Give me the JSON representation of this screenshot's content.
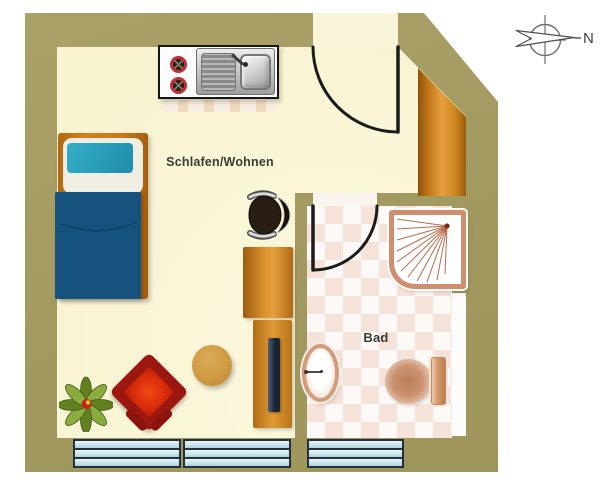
{
  "canvas": {
    "width": 600,
    "height": 492
  },
  "labels": {
    "room_main": "Schlafen/Wohnen",
    "room_bath": "Bad",
    "compass_north": "N"
  },
  "rooms": [
    {
      "id": "schlafen-wohnen",
      "label": "Schlafen/Wohnen"
    },
    {
      "id": "bad",
      "label": "Bad"
    }
  ],
  "colors": {
    "wall_olive": "#a49b61",
    "floor_main_cream": "#f8f4d2",
    "floor_bath_light": "#fdf9f6",
    "floor_bath_dark": "#f5e3da",
    "wood": "#d88f2b",
    "bed_frame": "#c4761f",
    "bed_pillow": "#2695b3",
    "bed_blanket": "#15537e",
    "armchair_frame": "#9b1710",
    "armchair_seat": "#dd2e0c",
    "stool": "#cf9a42",
    "window_glass": "#cfe7ee",
    "window_frame": "#25303d",
    "sanitary_trim": "#cf8e6d",
    "door_line": "#1b1b1b"
  },
  "furniture": [
    {
      "name": "kitchenette-stove-sink"
    },
    {
      "name": "single-bed"
    },
    {
      "name": "office-chair"
    },
    {
      "name": "desk"
    },
    {
      "name": "tv-sideboard"
    },
    {
      "name": "stool"
    },
    {
      "name": "armchair"
    },
    {
      "name": "plant"
    },
    {
      "name": "wardrobe"
    },
    {
      "name": "shower"
    },
    {
      "name": "washbasin"
    },
    {
      "name": "toilet"
    }
  ]
}
